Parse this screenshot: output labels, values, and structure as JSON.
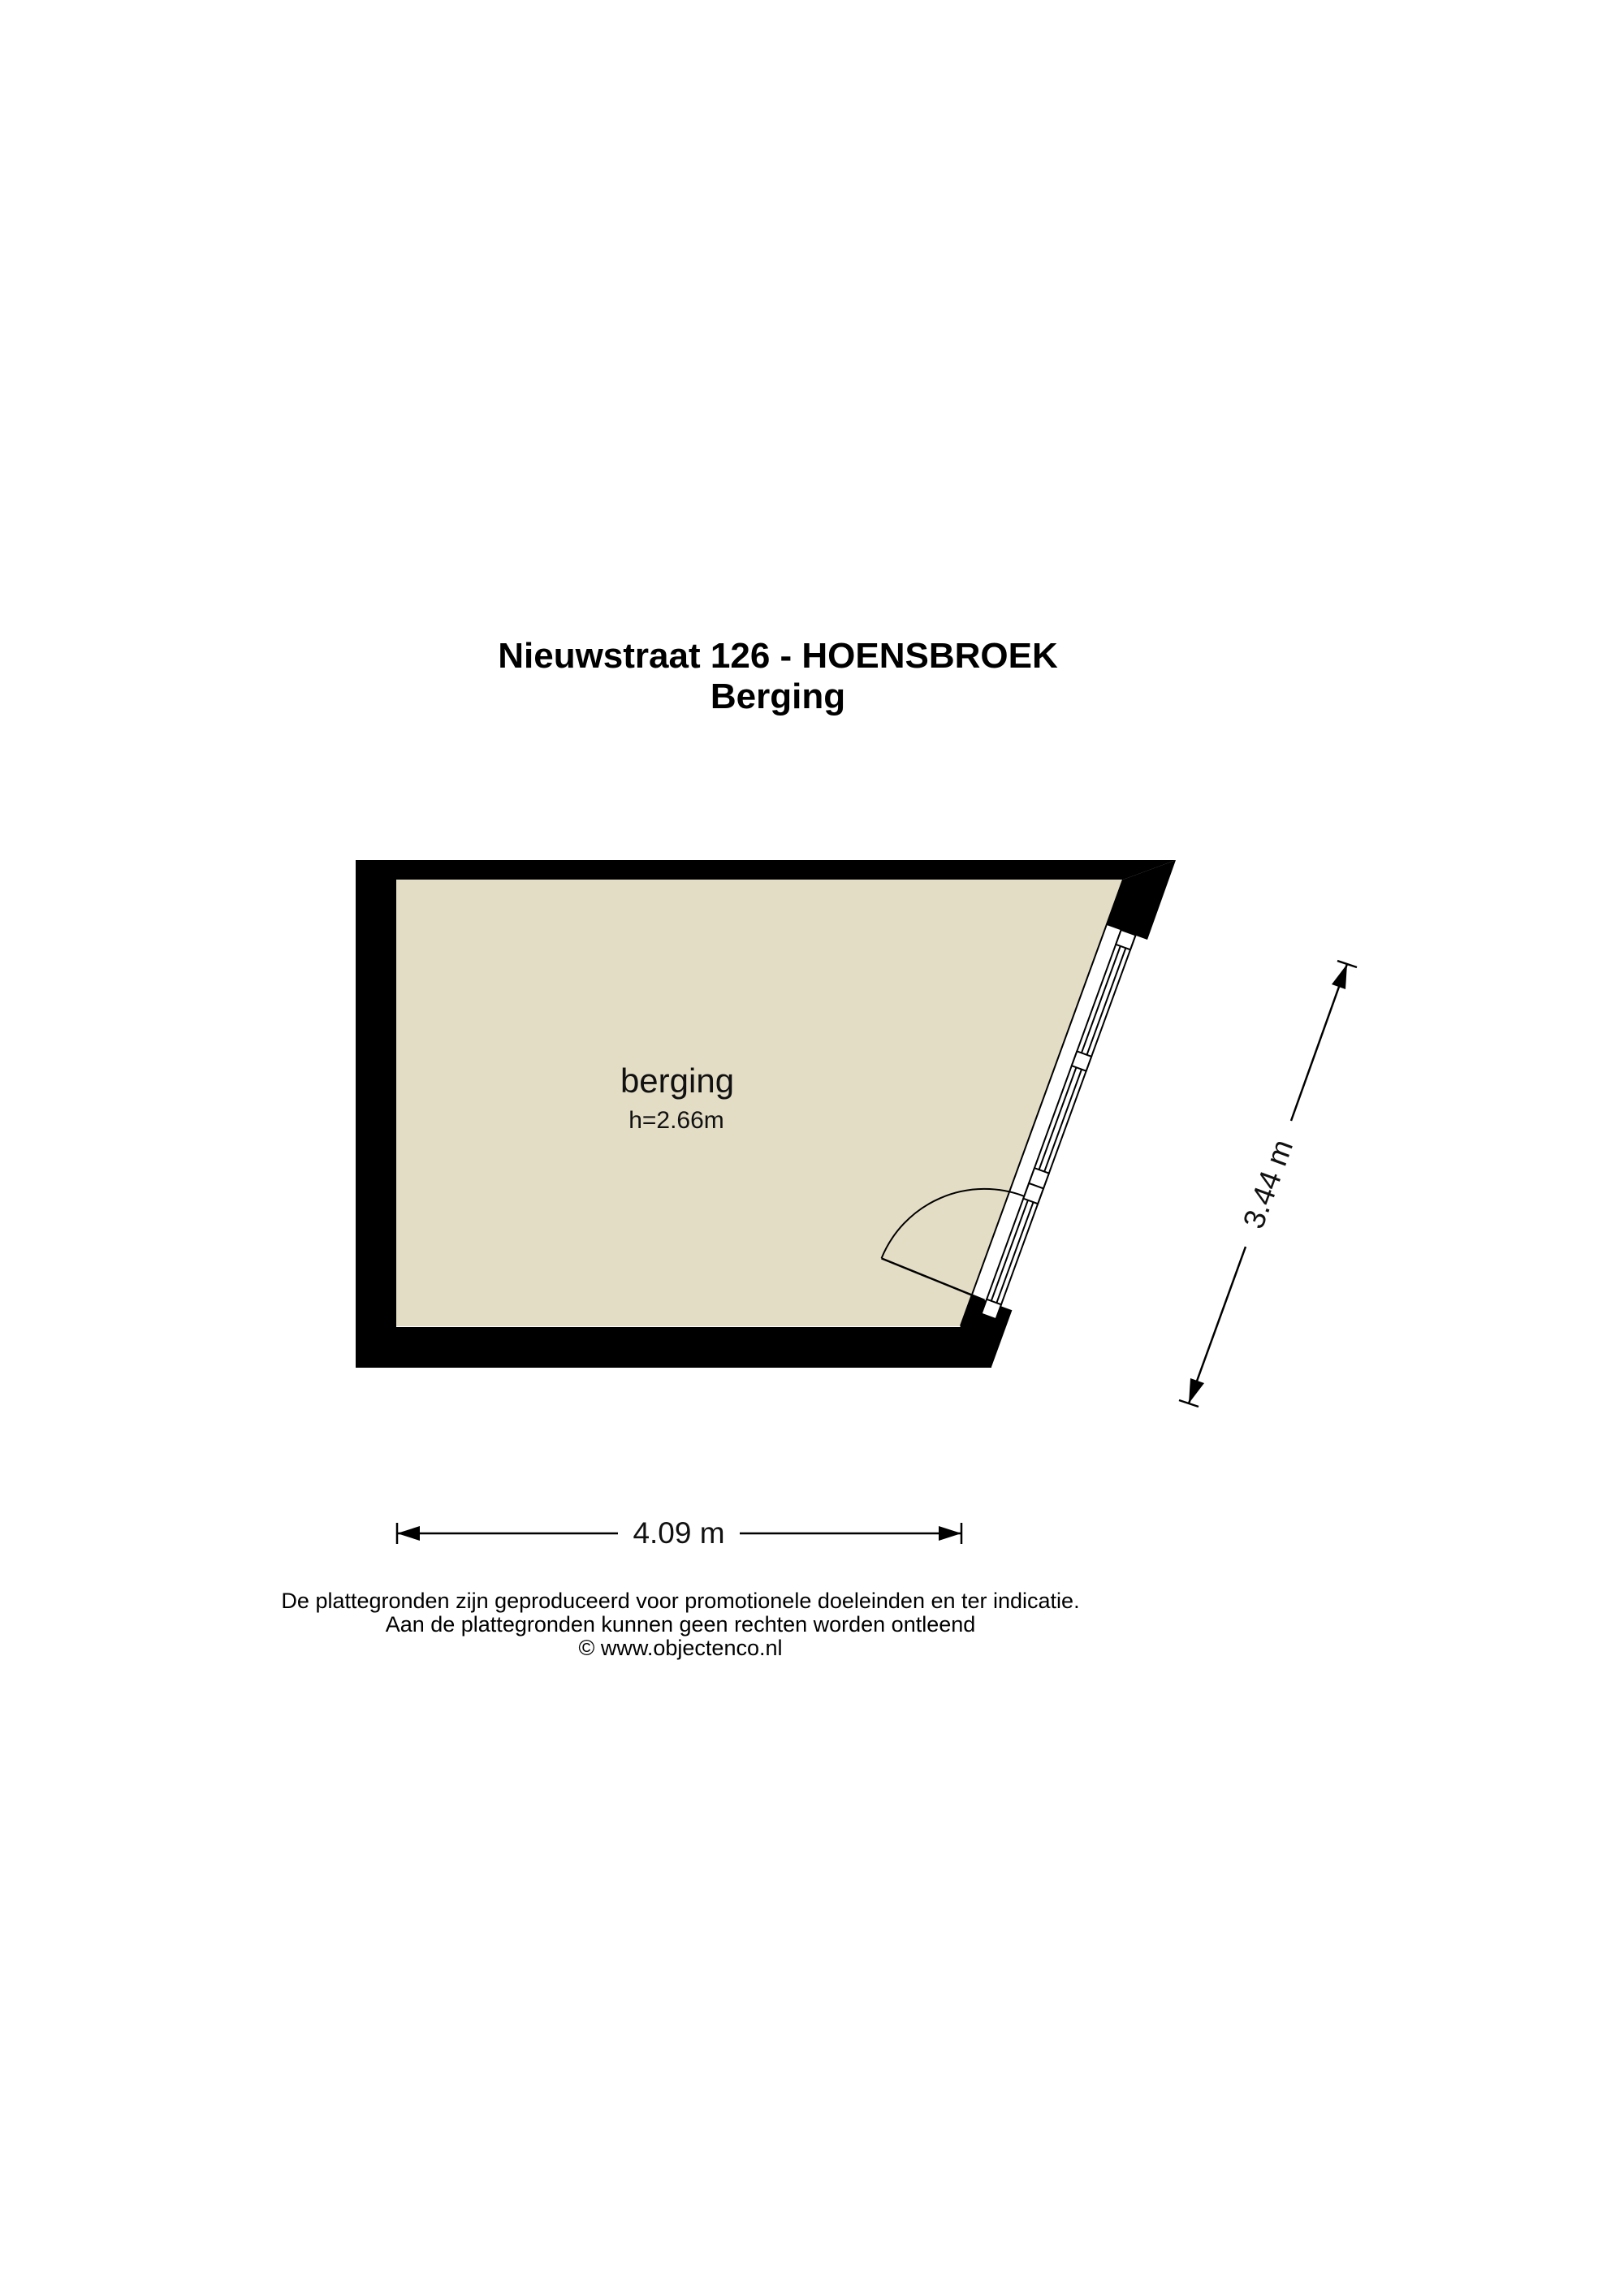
{
  "title": {
    "line1": "Nieuwstraat 126 - HOENSBROEK",
    "line2": "Berging"
  },
  "floor_plan": {
    "room_label": "berging",
    "ceiling_height_label": "h=2.66m"
  },
  "dimensions": {
    "bottom_width_label": "4.09 m",
    "right_depth_label": "3.44 m"
  },
  "footer": {
    "line1": "De plattegronden zijn geproduceerd voor promotionele doeleinden en ter indicatie.",
    "line2": "Aan de plattegronden kunnen geen rechten worden ontleend",
    "line3": "© www.objectenco.nl"
  },
  "colors": {
    "floor": "#E3DDC6",
    "wall": "#000000",
    "line": "#000000",
    "background": "#FFFFFF"
  }
}
